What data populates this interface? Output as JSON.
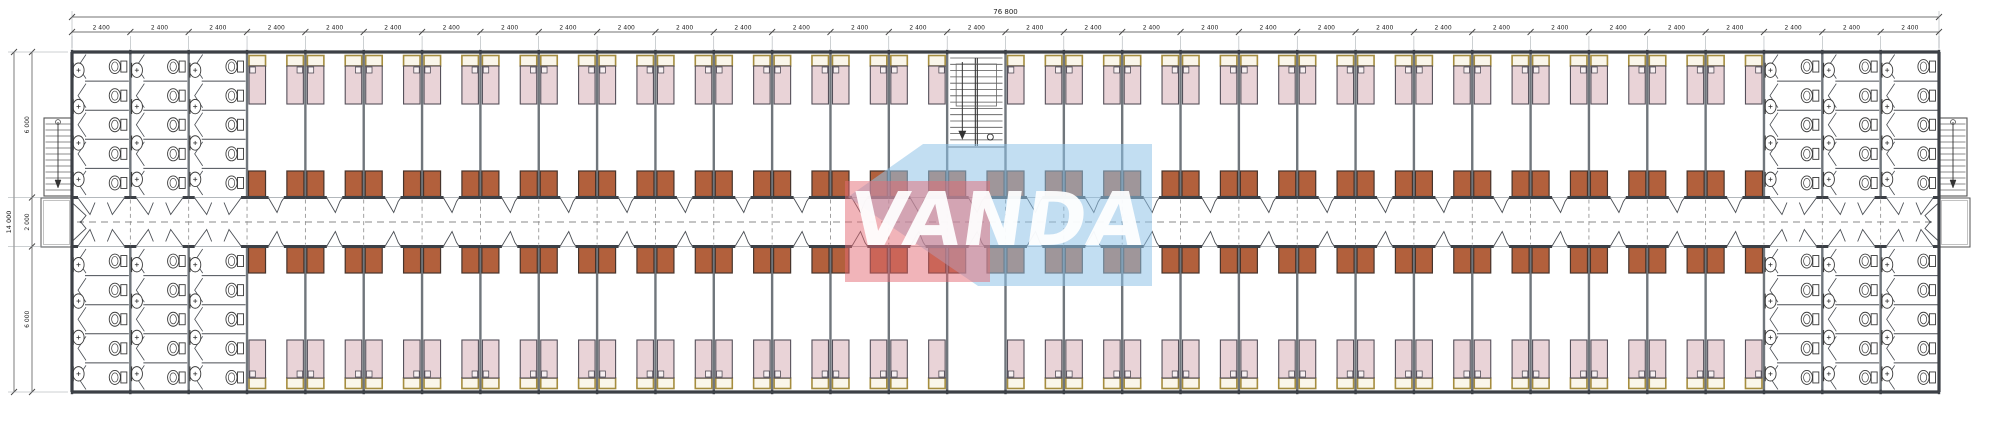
{
  "drawing": {
    "kind": "dormitory-floor-plan",
    "watermark": {
      "text": "VANDA"
    },
    "dimensions": {
      "overall_width": "76 800",
      "bay": "2 400",
      "bay_count": 32,
      "overall_depth": "14 000",
      "wing_depth": "6 000",
      "corridor_width": "2 000"
    },
    "plan": {
      "modules": 32,
      "washroom_modules_each_end": 3,
      "central_stair_module_index": 15,
      "beds_per_room": 2,
      "toilet_stalls_per_washroom_half": 5,
      "sinks_per_washroom_half": 4
    },
    "colors": {
      "wall": "#3c4046",
      "partition": "#70767c",
      "thin_line": "#4a4e54",
      "light_line": "#9aa0a6",
      "bed_fill": "#e9d3d7",
      "bed_outline": "#55505a",
      "pillow_fill": "#f7eff1",
      "headboard_fill": "#faf6ea",
      "headboard_border": "#a58d3f",
      "wardrobe_fill": "#b2603c",
      "wardrobe_outline": "#46342c",
      "fixture_fill": "#ffffff",
      "fixture_outline": "#3a3a3a",
      "dashed": "#8a8a8a",
      "dimension_line": "#444444",
      "dimension_text": "#222222",
      "watermark_red": "rgba(227,106,115,0.50)",
      "watermark_blue": "rgba(143,195,232,0.55)",
      "watermark_text": "rgba(255,255,255,0.93)"
    }
  }
}
